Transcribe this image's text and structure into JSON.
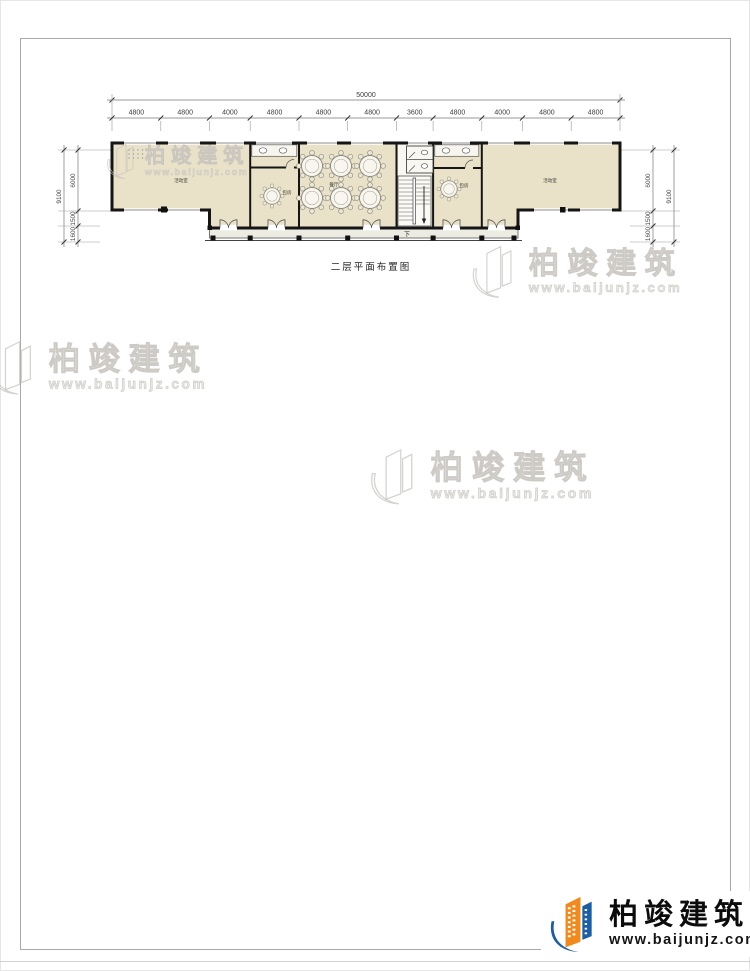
{
  "drawing": {
    "title": "二层平面布置图"
  },
  "dimensions": {
    "top_total": "50000",
    "top_segments": [
      "4800",
      "4800",
      "4000",
      "4800",
      "4800",
      "4800",
      "3600",
      "4800",
      "4000",
      "4800",
      "4800"
    ],
    "left_total": "9100",
    "left_segments": [
      "6000",
      "1500",
      "1600"
    ],
    "right_total": "9100",
    "right_segments": [
      "6000",
      "1500",
      "1600"
    ]
  },
  "plan": {
    "rooms": {
      "left_hall": "活动室",
      "left_private": "包房",
      "dining": "餐厅",
      "right_private": "包房",
      "right_hall": "活动室"
    },
    "stair_label": "下"
  },
  "watermark": {
    "brand": "柏竣建筑",
    "url": "www.baijunjz.com"
  },
  "logo": {
    "brand": "柏竣建筑",
    "url": "www.baijunjz.com"
  }
}
